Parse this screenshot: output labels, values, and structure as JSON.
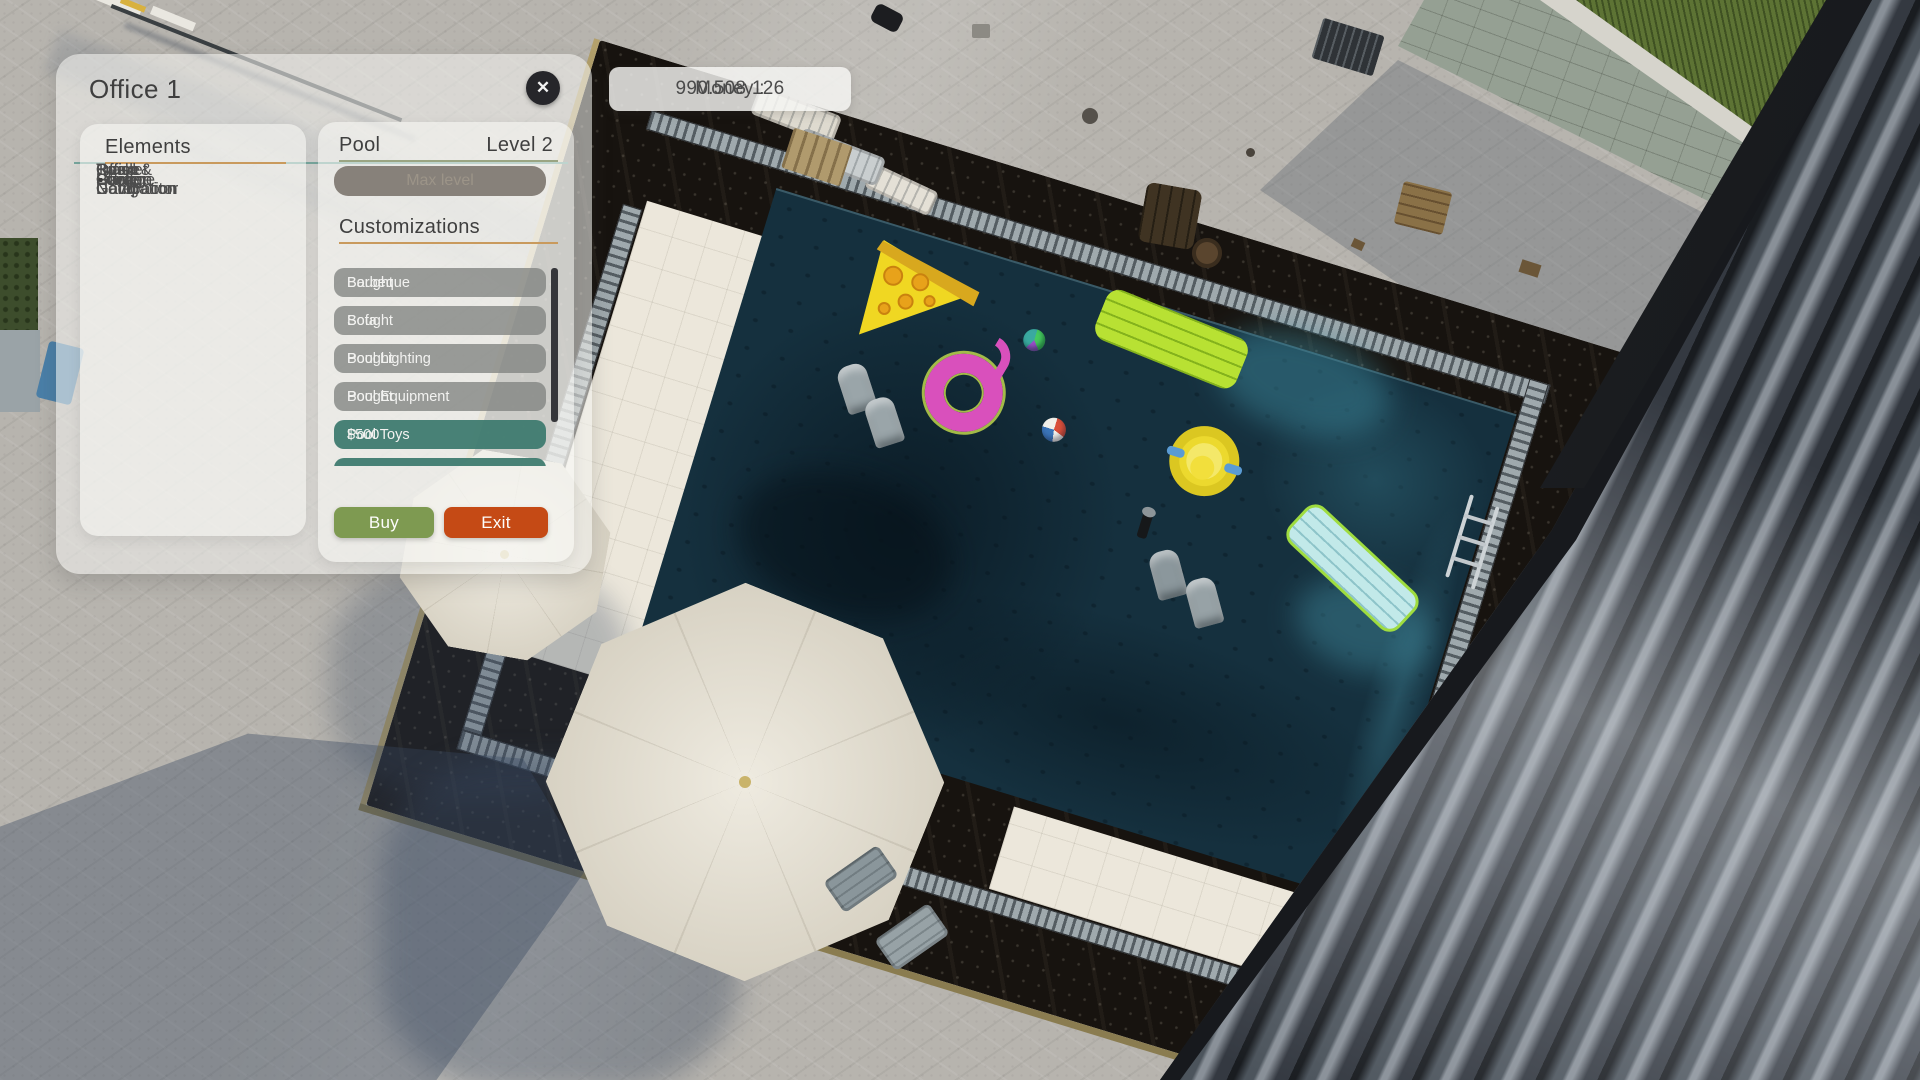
{
  "window": {
    "title": "Office 1",
    "close_icon": "✕"
  },
  "money": {
    "label": "Money :",
    "value": "990.508.126"
  },
  "elements_panel": {
    "header": "Elements",
    "items": [
      "Office",
      "Garage",
      "Trash Compactor",
      "Office Decoration",
      "Storage",
      "Fuel",
      "Power",
      "Office Gate",
      "Pool",
      "Garden",
      "Road & Navigation",
      "Basket Court"
    ],
    "bullet": "•"
  },
  "detail_panel": {
    "header": "Pool",
    "level": "Level 2",
    "upgrade_button": "Max level",
    "customizations_header": "Customizations",
    "customizations": [
      {
        "label": "Barbeque",
        "value": "Bought",
        "state": "bought"
      },
      {
        "label": "Sofa",
        "value": "Bought",
        "state": "bought"
      },
      {
        "label": "Pool Lighting",
        "value": "Bought",
        "state": "bought"
      },
      {
        "label": "Pool Equipment",
        "value": "Bought",
        "state": "bought"
      },
      {
        "label": "Pool Toys",
        "value": "$500",
        "state": "selected"
      },
      {
        "label": "Pool …",
        "value": "$10.000",
        "state": "selected",
        "partially_visible": true
      }
    ],
    "buy_button": "Buy",
    "exit_button": "Exit"
  },
  "ui_colors": {
    "title_rule_teal": "#77a69d",
    "section_rule_orange": "#c99a5d",
    "detail_rule_green": "#9aa583",
    "row_gray": "#828482",
    "row_selected_teal": "#3e7a6f",
    "buy_green": "#7e9a51",
    "exit_orange": "#c54a15",
    "disabled_button": "#87817a",
    "close_bg": "#26262a"
  },
  "scene": {
    "description": "aerial 3d view of villa pool area with floats, umbrellas, tiled roof",
    "palette": {
      "pavement": "#b7b4ae",
      "shadow_blue": "#4e5d74",
      "water": "#15303e",
      "water_caustic": "#2c6273",
      "deck_marble": "#17130f",
      "deck_trim_gold": "#b3a06b",
      "drain_gray": "#9fa9ad",
      "tile_cream": "#ece7db",
      "umbrella_cream": "#e9e4d6",
      "roof_dark": "#2b2f35",
      "roof_highlight": "#899098",
      "grass": "#5d7334",
      "wall": "#95a093",
      "beam": "#202327",
      "pizza_yellow": "#f0d722",
      "pepperoni_orange": "#e8a21a",
      "flamingo_pink": "#d950bc",
      "float_lime": "#b8e133",
      "duck_yellow": "#ecd92e",
      "mattress_blue": "#c2e9e9",
      "lounger_gray": "#8a969b"
    }
  }
}
